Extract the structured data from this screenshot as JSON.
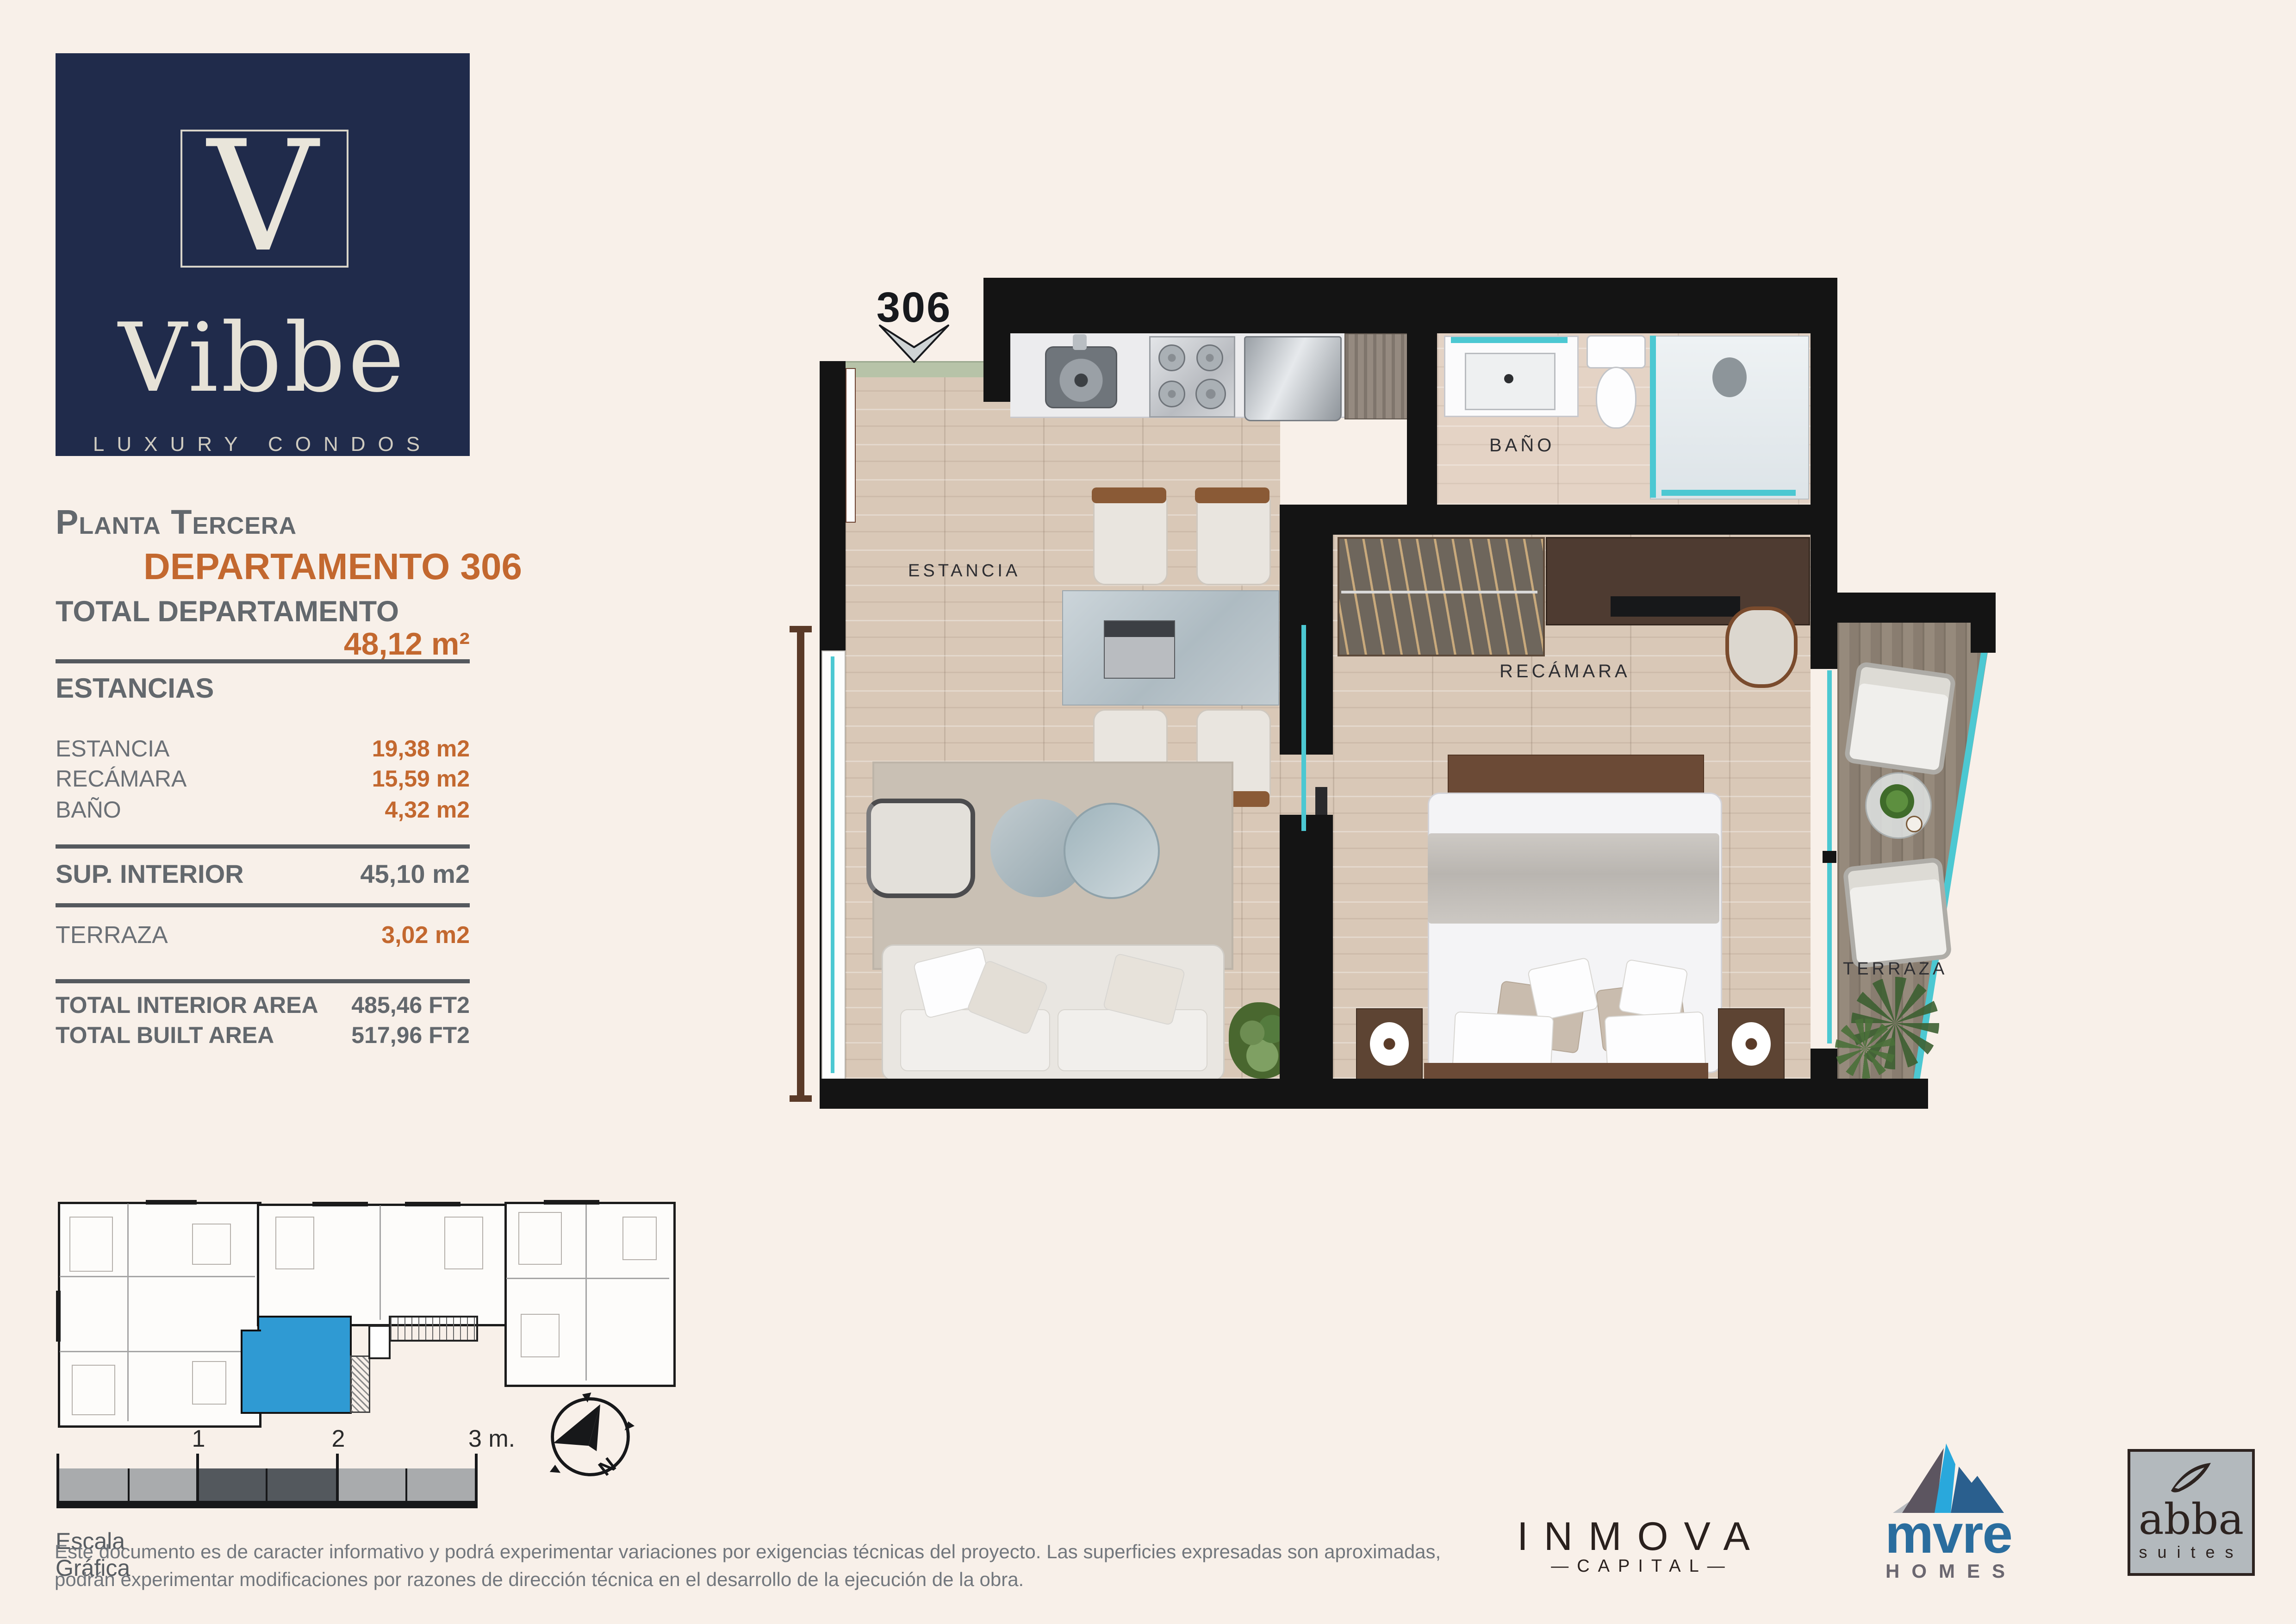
{
  "page": {
    "bg": "#f8f0e9"
  },
  "brand": {
    "monogram": "V",
    "name": "Vibbe",
    "tagline": "LUXURY CONDOS",
    "navy": "#202b4b",
    "cream": "#e9e5da"
  },
  "sidebar": {
    "floor_label": "Planta Tercera",
    "unit_label": "DEPARTAMENTO 306",
    "total_label": "TOTAL DEPARTAMENTO",
    "total_value": "48,12 m²",
    "sections_header": "ESTANCIAS",
    "rooms": [
      {
        "label": "ESTANCIA",
        "value": "19,38 m2"
      },
      {
        "label": "RECÁMARA",
        "value": "15,59 m2"
      },
      {
        "label": "BAÑO",
        "value": "4,32 m2"
      }
    ],
    "sup_interior_label": "SUP. INTERIOR",
    "sup_interior_value": "45,10 m2",
    "terraza_label": "TERRAZA",
    "terraza_value": "3,02 m2",
    "totals": [
      {
        "label": "TOTAL INTERIOR AREA",
        "value": "485,46 FT2"
      },
      {
        "label": "TOTAL BUILT AREA",
        "value": "517,96 FT2"
      }
    ]
  },
  "floorplan": {
    "unit_number": "306",
    "room_labels": {
      "living": "ESTANCIA",
      "bathroom": "BAÑO",
      "bedroom": "RECÁMARA",
      "terrace": "TERRAZA"
    },
    "accent_teal": "#4cc8d2",
    "wall_color": "#141414",
    "floor_color": "#d9c8b7"
  },
  "keyplan": {
    "highlight": "#2f9ad3"
  },
  "scalebar": {
    "tick_labels": [
      "1",
      "2",
      "3 m."
    ],
    "caption": "Escala Gráfica"
  },
  "compass": {
    "label": "N"
  },
  "disclaimer": {
    "line1": "Este documento es de caracter informativo y podrá experimentar variaciones por exigencias técnicas del proyecto. Las superficies expresadas son aproximadas,",
    "line2": "podrán experimentar modificaciones por razones de dirección técnica en el desarrollo de la ejecución de la obra."
  },
  "partners": {
    "inmova_name": "INMOVA",
    "inmova_sub": "CAPITAL",
    "mvre_name": "mvre",
    "mvre_sub": "HOMES",
    "abba_name": "abba",
    "abba_sub": "suites"
  }
}
